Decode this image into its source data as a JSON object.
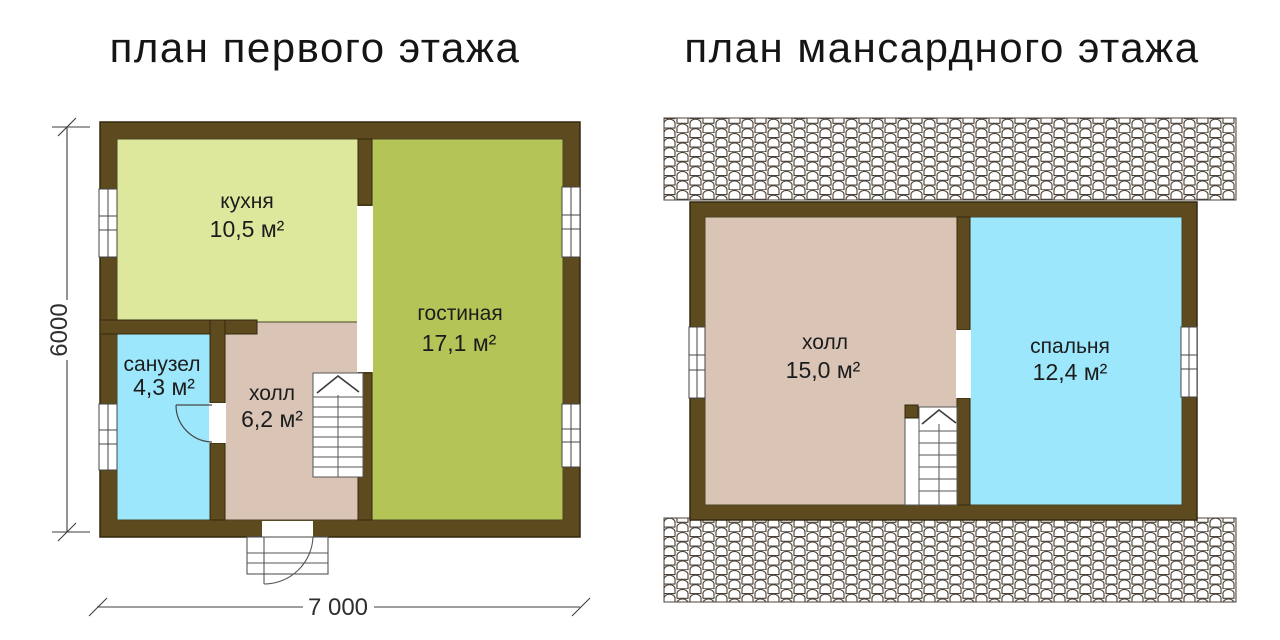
{
  "titles": {
    "left": "план первого этажа",
    "right": "план мансардного этажа"
  },
  "left_plan": {
    "rooms": [
      {
        "name": "кухня",
        "area": "10,5 м²",
        "color": "#dde89c"
      },
      {
        "name": "гостиная",
        "area": "17,1 м²",
        "color": "#b5c457"
      },
      {
        "name": "санузел",
        "area": "4,3 м²",
        "color": "#9ce7fb"
      },
      {
        "name": "холл",
        "area": "6,2 м²",
        "color": "#d9c4b6"
      }
    ],
    "dimensions": {
      "height": "6000",
      "width": "7 000"
    }
  },
  "right_plan": {
    "rooms": [
      {
        "name": "холл",
        "area": "15,0 м²",
        "color": "#d9c4b6"
      },
      {
        "name": "спальня",
        "area": "12,4 м²",
        "color": "#9ce7fb"
      }
    ]
  },
  "colors": {
    "wall": "#5d4a1e",
    "wall_outline": "#33290f",
    "room_outline": "#4a4424",
    "line": "#4c4c4c",
    "roof_tile_stroke": "#4a423a",
    "roof_tile_bg": "#f8f4ee",
    "text": "#1c1c1c",
    "background": "#ffffff"
  }
}
